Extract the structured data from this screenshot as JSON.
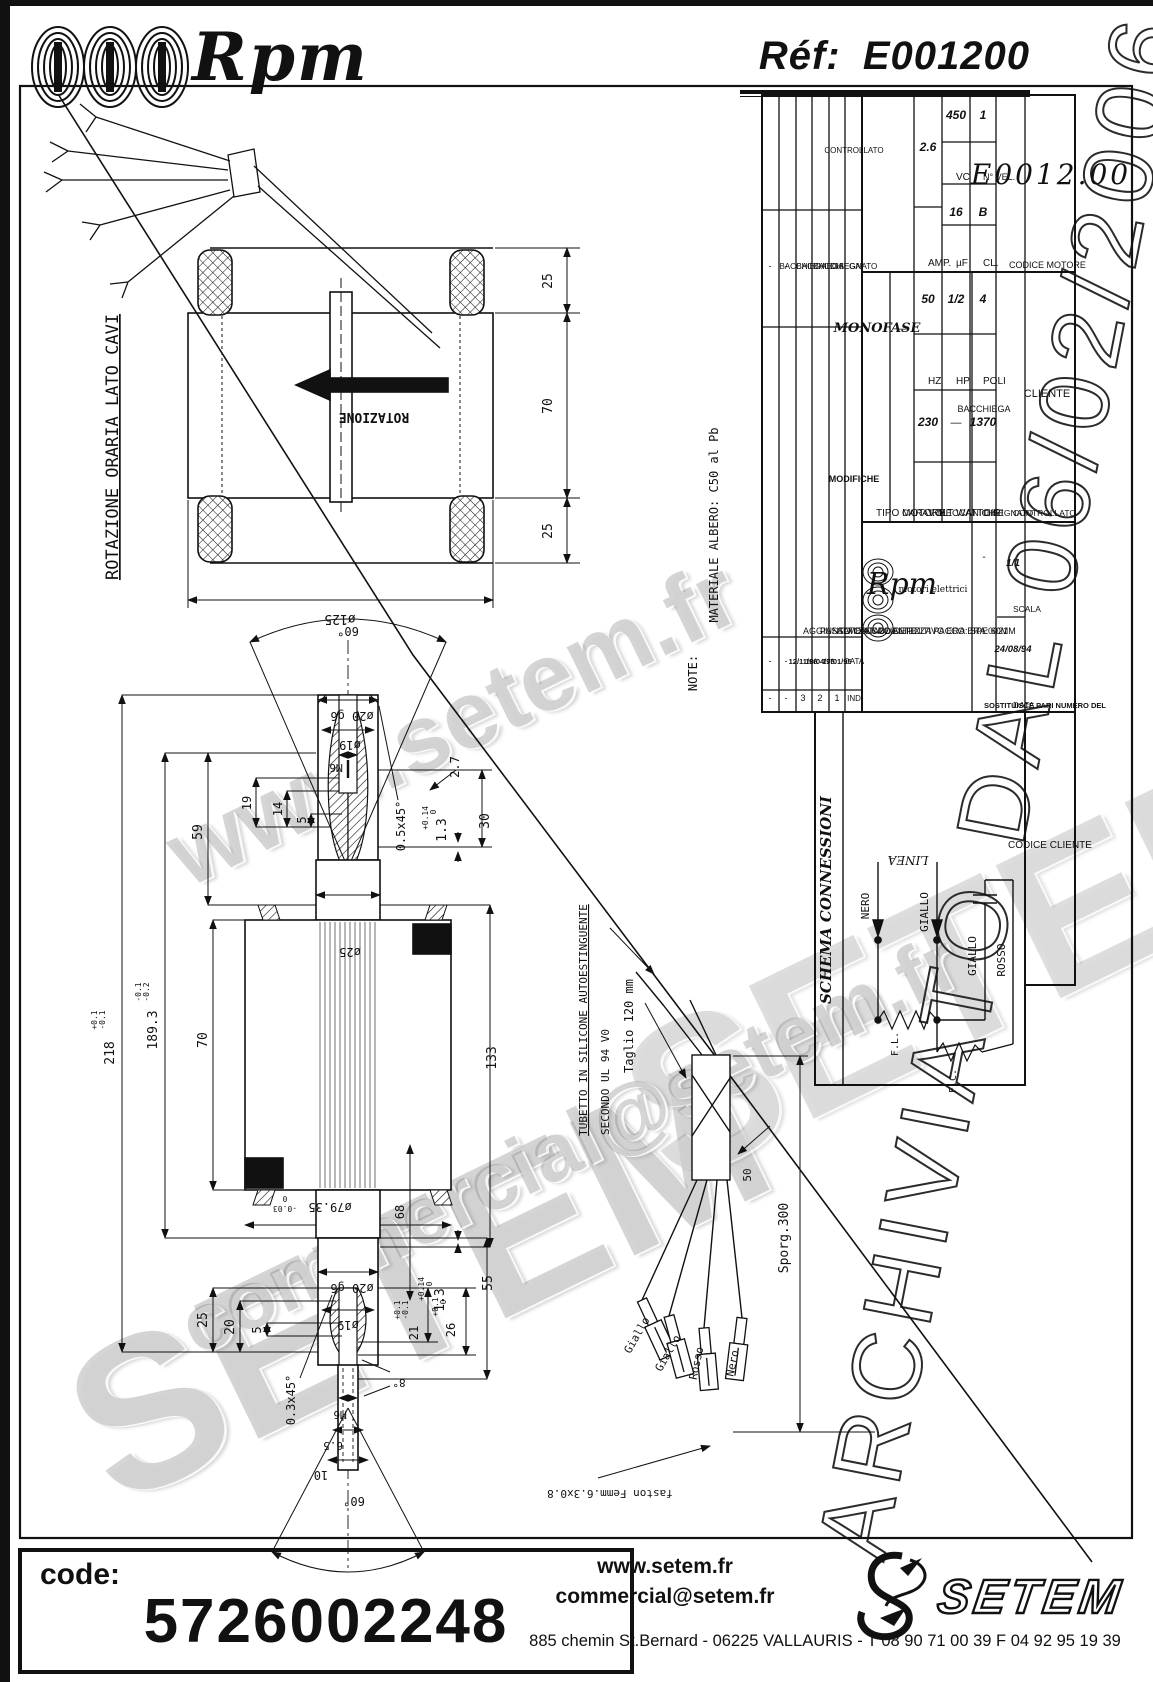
{
  "header": {
    "brand": "Rpm",
    "ref_label": "Réf:",
    "ref_value": "E001200"
  },
  "watermarks": {
    "site": "www.setem.fr",
    "setem": "SETEM",
    "mail": "commercial@setem.fr",
    "archive": "ARCHIVIATO DAL 06/02/2006"
  },
  "footer": {
    "code_label": "code:",
    "code_value": "5726002248",
    "site": "www.setem.fr",
    "email": "commercial@setem.fr",
    "address": "885 chemin St.Bernard  -  06225 VALLAURIS  -  T 08 90 71 00 39   F 04 92 95 19 39",
    "logo_text": "SETEM"
  },
  "labels": {
    "stator": [
      {
        "t": "ROTAZIONE ORARIA LATO CAVI",
        "x": 118,
        "y": 447,
        "r": -90,
        "s": 17,
        "u": 1
      },
      {
        "t": "ROTAZIONE",
        "x": 374,
        "y": 413,
        "r": 180,
        "s": 13,
        "b": 1
      },
      {
        "t": "25",
        "x": 552,
        "y": 281,
        "r": -90,
        "s": 13
      },
      {
        "t": "70",
        "x": 552,
        "y": 406,
        "r": -90,
        "s": 13
      },
      {
        "t": "25",
        "x": 552,
        "y": 531,
        "r": -90,
        "s": 13
      },
      {
        "t": "ø125",
        "x": 340,
        "y": 615,
        "r": 180,
        "s": 13
      }
    ],
    "rotor": [
      {
        "t": "60°",
        "x": 348,
        "y": 627,
        "r": 180,
        "s": 12
      },
      {
        "t": "ø20 g6",
        "x": 352,
        "y": 712,
        "r": 180,
        "s": 12
      },
      {
        "t": "ø19",
        "x": 350,
        "y": 741,
        "r": 180,
        "s": 12
      },
      {
        "t": "M6",
        "x": 336,
        "y": 764,
        "r": 180,
        "s": 11
      },
      {
        "t": "19",
        "x": 251,
        "y": 803,
        "r": -90,
        "s": 12
      },
      {
        "t": "14",
        "x": 282,
        "y": 809,
        "r": -90,
        "s": 12
      },
      {
        "t": "5",
        "x": 306,
        "y": 820,
        "r": -90,
        "s": 12
      },
      {
        "t": "59",
        "x": 202,
        "y": 832,
        "r": -90,
        "s": 13
      },
      {
        "t": "0.5x45°",
        "x": 405,
        "y": 826,
        "r": -90,
        "s": 12
      },
      {
        "t": "+0.14",
        "x": 428,
        "y": 818,
        "r": -90,
        "s": 8
      },
      {
        "t": "0",
        "x": 436,
        "y": 812,
        "r": -90,
        "s": 8
      },
      {
        "t": "1.3",
        "x": 446,
        "y": 830,
        "r": -90,
        "s": 13
      },
      {
        "t": "2.7",
        "x": 459,
        "y": 767,
        "r": -90,
        "s": 12
      },
      {
        "t": "30",
        "x": 489,
        "y": 821,
        "r": -90,
        "s": 13
      },
      {
        "t": "ø25",
        "x": 350,
        "y": 948,
        "r": 180,
        "s": 12
      },
      {
        "t": "70",
        "x": 207,
        "y": 1040,
        "r": -90,
        "s": 13
      },
      {
        "t": "-0.1",
        "x": 141,
        "y": 992,
        "r": -90,
        "s": 8
      },
      {
        "t": "-0.2",
        "x": 149,
        "y": 992,
        "r": -90,
        "s": 8
      },
      {
        "t": "189.3",
        "x": 157,
        "y": 1030,
        "r": -90,
        "s": 13
      },
      {
        "t": "+0.1",
        "x": 97,
        "y": 1020,
        "r": -90,
        "s": 8
      },
      {
        "t": "-0.1",
        "x": 105,
        "y": 1020,
        "r": -90,
        "s": 8
      },
      {
        "t": "218",
        "x": 114,
        "y": 1053,
        "r": -90,
        "s": 13
      },
      {
        "t": "133",
        "x": 496,
        "y": 1058,
        "r": -90,
        "s": 13
      },
      {
        "t": "0",
        "x": 285,
        "y": 1196,
        "r": 180,
        "s": 8
      },
      {
        "t": "-0.03",
        "x": 285,
        "y": 1206,
        "r": 180,
        "s": 8
      },
      {
        "t": "ø79.35",
        "x": 330,
        "y": 1203,
        "r": 180,
        "s": 12
      },
      {
        "t": "68",
        "x": 404,
        "y": 1212,
        "r": -90,
        "s": 12
      },
      {
        "t": "ø20 g6",
        "x": 352,
        "y": 1284,
        "r": 180,
        "s": 12
      },
      {
        "t": "ø19",
        "x": 348,
        "y": 1321,
        "r": 180,
        "s": 12
      },
      {
        "t": "+0.14",
        "x": 424,
        "y": 1289,
        "r": -90,
        "s": 8
      },
      {
        "t": "0",
        "x": 432,
        "y": 1284,
        "r": -90,
        "s": 8
      },
      {
        "t": "1.3",
        "x": 444,
        "y": 1300,
        "r": -90,
        "s": 13
      },
      {
        "t": "55",
        "x": 492,
        "y": 1283,
        "r": -90,
        "s": 13
      },
      {
        "t": "25",
        "x": 207,
        "y": 1320,
        "r": -90,
        "s": 13
      },
      {
        "t": "20",
        "x": 234,
        "y": 1327,
        "r": -90,
        "s": 13
      },
      {
        "t": "5",
        "x": 261,
        "y": 1330,
        "r": -90,
        "s": 12
      },
      {
        "t": "+0.1",
        "x": 400,
        "y": 1310,
        "r": -90,
        "s": 8
      },
      {
        "t": "-0.1",
        "x": 408,
        "y": 1310,
        "r": -90,
        "s": 8
      },
      {
        "t": "21",
        "x": 418,
        "y": 1333,
        "r": -90,
        "s": 12
      },
      {
        "t": "+0.1",
        "x": 438,
        "y": 1307,
        "r": -90,
        "s": 8
      },
      {
        "t": "0",
        "x": 446,
        "y": 1302,
        "r": -90,
        "s": 8
      },
      {
        "t": "26",
        "x": 455,
        "y": 1330,
        "r": -90,
        "s": 12
      },
      {
        "t": "0.3x45°",
        "x": 295,
        "y": 1400,
        "r": -90,
        "s": 12
      },
      {
        "t": "M6",
        "x": 340,
        "y": 1411,
        "r": 180,
        "s": 11
      },
      {
        "t": "6.5",
        "x": 333,
        "y": 1442,
        "r": 180,
        "s": 11
      },
      {
        "t": "10",
        "x": 321,
        "y": 1471,
        "r": 180,
        "s": 12
      },
      {
        "t": "60°",
        "x": 354,
        "y": 1497,
        "r": 180,
        "s": 12
      },
      {
        "t": "8°",
        "x": 399,
        "y": 1379,
        "r": 180,
        "s": 11
      }
    ],
    "cable": [
      {
        "t": "TUBETTO IN SILICONE AUTOESTINGUENTE",
        "x": 587,
        "y": 1020,
        "r": -90,
        "s": 11,
        "u": 1
      },
      {
        "t": "SECONDO UL 94 V0",
        "x": 609,
        "y": 1082,
        "r": -90,
        "s": 11
      },
      {
        "t": "Taglio 120 mm",
        "x": 633,
        "y": 1026,
        "r": -90,
        "s": 12
      },
      {
        "t": "Sporg.300",
        "x": 788,
        "y": 1238,
        "r": -90,
        "s": 13
      },
      {
        "t": "50",
        "x": 751,
        "y": 1175,
        "r": -90,
        "s": 11
      },
      {
        "t": "Giallo",
        "x": 640,
        "y": 1337,
        "r": -60,
        "s": 11
      },
      {
        "t": "Giallo",
        "x": 671,
        "y": 1355,
        "r": -60,
        "s": 11
      },
      {
        "t": "Rosso",
        "x": 700,
        "y": 1364,
        "r": -78,
        "s": 11
      },
      {
        "t": "Nero",
        "x": 736,
        "y": 1364,
        "r": -78,
        "s": 11
      },
      {
        "t": "faston Femm.6.3x0.8",
        "x": 610,
        "y": 1490,
        "r": 180,
        "s": 11
      }
    ],
    "note": [
      {
        "t": "NOTE:",
        "x": 697,
        "y": 673,
        "r": -90,
        "s": 12
      },
      {
        "t": "MATERIALE ALBERO: C50 al Pb",
        "x": 718,
        "y": 525,
        "r": -90,
        "s": 12
      }
    ],
    "schema": [
      {
        "t": "SCHEMA CONNESSIONI",
        "x": 831,
        "y": 900,
        "r": -90,
        "s": 15,
        "b": 1,
        "i": 1,
        "ff": "serif"
      },
      {
        "t": "LINEA",
        "x": 908,
        "y": 856,
        "r": 180,
        "s": 12,
        "i": 1,
        "ff": "serif"
      },
      {
        "t": "NERO",
        "x": 869,
        "y": 906,
        "r": -90,
        "s": 11
      },
      {
        "t": "GIALLO",
        "x": 928,
        "y": 912,
        "r": -90,
        "s": 11
      },
      {
        "t": "GIALLO",
        "x": 976,
        "y": 956,
        "r": -90,
        "s": 11
      },
      {
        "t": "ROSSO",
        "x": 1005,
        "y": 960,
        "r": -90,
        "s": 11
      },
      {
        "t": "F.L.",
        "x": 898,
        "y": 1044,
        "r": -90,
        "s": 10
      },
      {
        "t": "F.C.",
        "x": 956,
        "y": 1081,
        "r": -90,
        "s": 10
      }
    ],
    "titleblock": [
      {
        "t": "IND",
        "x": 854,
        "y": 701,
        "s": 8,
        "ff": "sans"
      },
      {
        "t": "DATA",
        "x": 854,
        "y": 664,
        "s": 8,
        "ff": "sans"
      },
      {
        "t": "MODIFICHE",
        "x": 854,
        "y": 482,
        "s": 9,
        "b": 1,
        "ff": "sans"
      },
      {
        "t": "DISEGNATO",
        "x": 854,
        "y": 269,
        "s": 8,
        "ff": "sans"
      },
      {
        "t": "CONTROLLATO",
        "x": 854,
        "y": 153,
        "s": 8,
        "ff": "sans"
      },
      {
        "t": "1",
        "x": 837,
        "y": 701,
        "s": 9,
        "ff": "sans"
      },
      {
        "t": "17/01/95",
        "x": 837,
        "y": 664,
        "s": 7.5,
        "b": 1,
        "ff": "sans"
      },
      {
        "t": "ALMENTATO ALTEZZA PACCO ERA: 60MM",
        "x": 837,
        "y": 634,
        "a": "s",
        "s": 9,
        "ff": "sans"
      },
      {
        "t": "BACCHIEGA",
        "x": 837,
        "y": 269,
        "s": 8,
        "ff": "sans"
      },
      {
        "t": "2",
        "x": 820,
        "y": 701,
        "s": 9,
        "ff": "sans"
      },
      {
        "t": "18/04/95",
        "x": 820,
        "y": 664,
        "s": 7.5,
        "b": 1,
        "ff": "sans"
      },
      {
        "t": "PASSATO A COD.DEFINITIVO ERA: SPE0021",
        "x": 820,
        "y": 634,
        "a": "s",
        "s": 9,
        "ff": "sans"
      },
      {
        "t": "BACCHIEGA",
        "x": 820,
        "y": 269,
        "s": 8,
        "ff": "sans"
      },
      {
        "t": "3",
        "x": 803,
        "y": 701,
        "s": 9,
        "ff": "sans"
      },
      {
        "t": "12/11/96",
        "x": 803,
        "y": 664,
        "s": 7.5,
        "b": 1,
        "ff": "sans"
      },
      {
        "t": "AGGIUNTO COD. CLIENTE",
        "x": 803,
        "y": 634,
        "a": "s",
        "s": 9,
        "ff": "sans"
      },
      {
        "t": "BACCHIEGA",
        "x": 803,
        "y": 269,
        "s": 8,
        "ff": "sans"
      },
      {
        "t": "-",
        "x": 786,
        "y": 701,
        "s": 9,
        "ff": "sans"
      },
      {
        "t": "-",
        "x": 786,
        "y": 664,
        "s": 9,
        "ff": "sans"
      },
      {
        "t": "-",
        "x": 786,
        "y": 269,
        "s": 9,
        "ff": "sans"
      },
      {
        "t": "-",
        "x": 770,
        "y": 701,
        "s": 9,
        "ff": "sans"
      },
      {
        "t": "-",
        "x": 770,
        "y": 664,
        "s": 9,
        "ff": "sans"
      },
      {
        "t": "-",
        "x": 770,
        "y": 269,
        "s": 9,
        "ff": "sans"
      },
      {
        "t": "TIPO MOTORE",
        "x": 876,
        "y": 516,
        "a": "s",
        "s": 10,
        "ff": "sans"
      },
      {
        "t": "MONOFASE",
        "x": 877,
        "y": 332,
        "s": 13,
        "b": 1,
        "i": 1,
        "ff": "serif"
      },
      {
        "t": "CARAT. MECCANICHE",
        "x": 902,
        "y": 516,
        "a": "s",
        "s": 9.5,
        "ff": "sans"
      },
      {
        "t": "—",
        "x": 902,
        "y": 332,
        "s": 11,
        "ff": "sans"
      },
      {
        "t": "VOLT",
        "x": 928,
        "y": 516,
        "a": "s",
        "s": 10,
        "ff": "sans"
      },
      {
        "t": "230",
        "x": 928,
        "y": 426,
        "s": 12,
        "b": 1,
        "i": 1,
        "ff": "sans"
      },
      {
        "t": "HZ",
        "x": 928,
        "y": 384,
        "a": "s",
        "s": 10,
        "ff": "sans"
      },
      {
        "t": "50",
        "x": 928,
        "y": 303,
        "s": 12,
        "b": 1,
        "i": 1,
        "ff": "sans"
      },
      {
        "t": "AMP.",
        "x": 928,
        "y": 266,
        "a": "s",
        "s": 10,
        "ff": "sans"
      },
      {
        "t": "2.6",
        "x": 928,
        "y": 151,
        "s": 12,
        "b": 1,
        "i": 1,
        "ff": "sans"
      },
      {
        "t": "WATT",
        "x": 956,
        "y": 516,
        "a": "s",
        "s": 10,
        "ff": "sans"
      },
      {
        "t": "—",
        "x": 956,
        "y": 426,
        "s": 11,
        "ff": "sans"
      },
      {
        "t": "HP",
        "x": 956,
        "y": 384,
        "a": "s",
        "s": 10,
        "ff": "sans"
      },
      {
        "t": "1/2",
        "x": 956,
        "y": 303,
        "s": 12,
        "b": 1,
        "i": 1,
        "ff": "sans"
      },
      {
        "t": "µF",
        "x": 956,
        "y": 266,
        "a": "s",
        "s": 10,
        "ff": "sans"
      },
      {
        "t": "16",
        "x": 956,
        "y": 216,
        "s": 12,
        "b": 1,
        "i": 1,
        "ff": "sans"
      },
      {
        "t": "VC",
        "x": 956,
        "y": 180,
        "a": "s",
        "s": 10,
        "ff": "sans"
      },
      {
        "t": "450",
        "x": 956,
        "y": 119,
        "s": 12,
        "b": 1,
        "i": 1,
        "ff": "sans"
      },
      {
        "t": "GIRI",
        "x": 983,
        "y": 516,
        "a": "s",
        "s": 10,
        "ff": "sans"
      },
      {
        "t": "1370",
        "x": 983,
        "y": 426,
        "s": 12,
        "b": 1,
        "i": 1,
        "ff": "sans"
      },
      {
        "t": "POLI",
        "x": 983,
        "y": 384,
        "a": "s",
        "s": 10,
        "ff": "sans"
      },
      {
        "t": "4",
        "x": 983,
        "y": 303,
        "s": 12,
        "b": 1,
        "i": 1,
        "ff": "sans"
      },
      {
        "t": "CL.",
        "x": 983,
        "y": 266,
        "a": "s",
        "s": 10,
        "ff": "sans"
      },
      {
        "t": "B",
        "x": 983,
        "y": 216,
        "s": 12,
        "b": 1,
        "i": 1,
        "ff": "sans"
      },
      {
        "t": "N° VEL.",
        "x": 983,
        "y": 180,
        "a": "s",
        "s": 9,
        "ff": "sans"
      },
      {
        "t": "1",
        "x": 983,
        "y": 119,
        "s": 12,
        "b": 1,
        "i": 1,
        "ff": "sans"
      },
      {
        "t": "CLIENTE",
        "x": 1047,
        "y": 397,
        "s": 11,
        "ff": "sans"
      },
      {
        "t": "CODICE MOTORE",
        "x": 1009,
        "y": 268,
        "a": "s",
        "s": 9,
        "ff": "sans"
      },
      {
        "t": "E0012.00",
        "x": 1051,
        "y": 184,
        "s": 28,
        "i": 1,
        "ff": "serif",
        "sp": 3
      },
      {
        "t": "CODICE CLIENTE",
        "x": 1050,
        "y": 848,
        "s": 10,
        "ff": "sans"
      },
      {
        "t": "Rpm",
        "x": 902,
        "y": 594,
        "s": 30,
        "i": 1,
        "ff": "serif"
      },
      {
        "t": "motori elettrici",
        "x": 933,
        "y": 592,
        "s": 9,
        "ff": "serif"
      },
      {
        "t": "SOSTITUISCE PARI NUMERO DEL",
        "x": 984,
        "y": 708,
        "a": "s",
        "s": 7.5,
        "b": 1,
        "ff": "sans"
      },
      {
        "t": "-",
        "x": 984,
        "y": 560,
        "s": 10,
        "ff": "sans"
      },
      {
        "t": "DATA",
        "x": 1013,
        "y": 708,
        "a": "s",
        "s": 8.5,
        "ff": "sans"
      },
      {
        "t": "24/08/94",
        "x": 1013,
        "y": 652,
        "s": 9.5,
        "b": 1,
        "i": 1,
        "ff": "sans"
      },
      {
        "t": "SCALA",
        "x": 1013,
        "y": 612,
        "a": "s",
        "s": 8.5,
        "ff": "sans"
      },
      {
        "t": "1/1",
        "x": 1013,
        "y": 566,
        "s": 10,
        "b": 1,
        "i": 1,
        "ff": "sans"
      },
      {
        "t": "DISEGNATO",
        "x": 984,
        "y": 516,
        "a": "s",
        "s": 8.5,
        "ff": "sans"
      },
      {
        "t": "BACCHIEGA",
        "x": 984,
        "y": 412,
        "s": 9,
        "ff": "sans"
      },
      {
        "t": "CONTROLLATO",
        "x": 1013,
        "y": 516,
        "a": "s",
        "s": 8.5,
        "ff": "sans"
      }
    ]
  }
}
